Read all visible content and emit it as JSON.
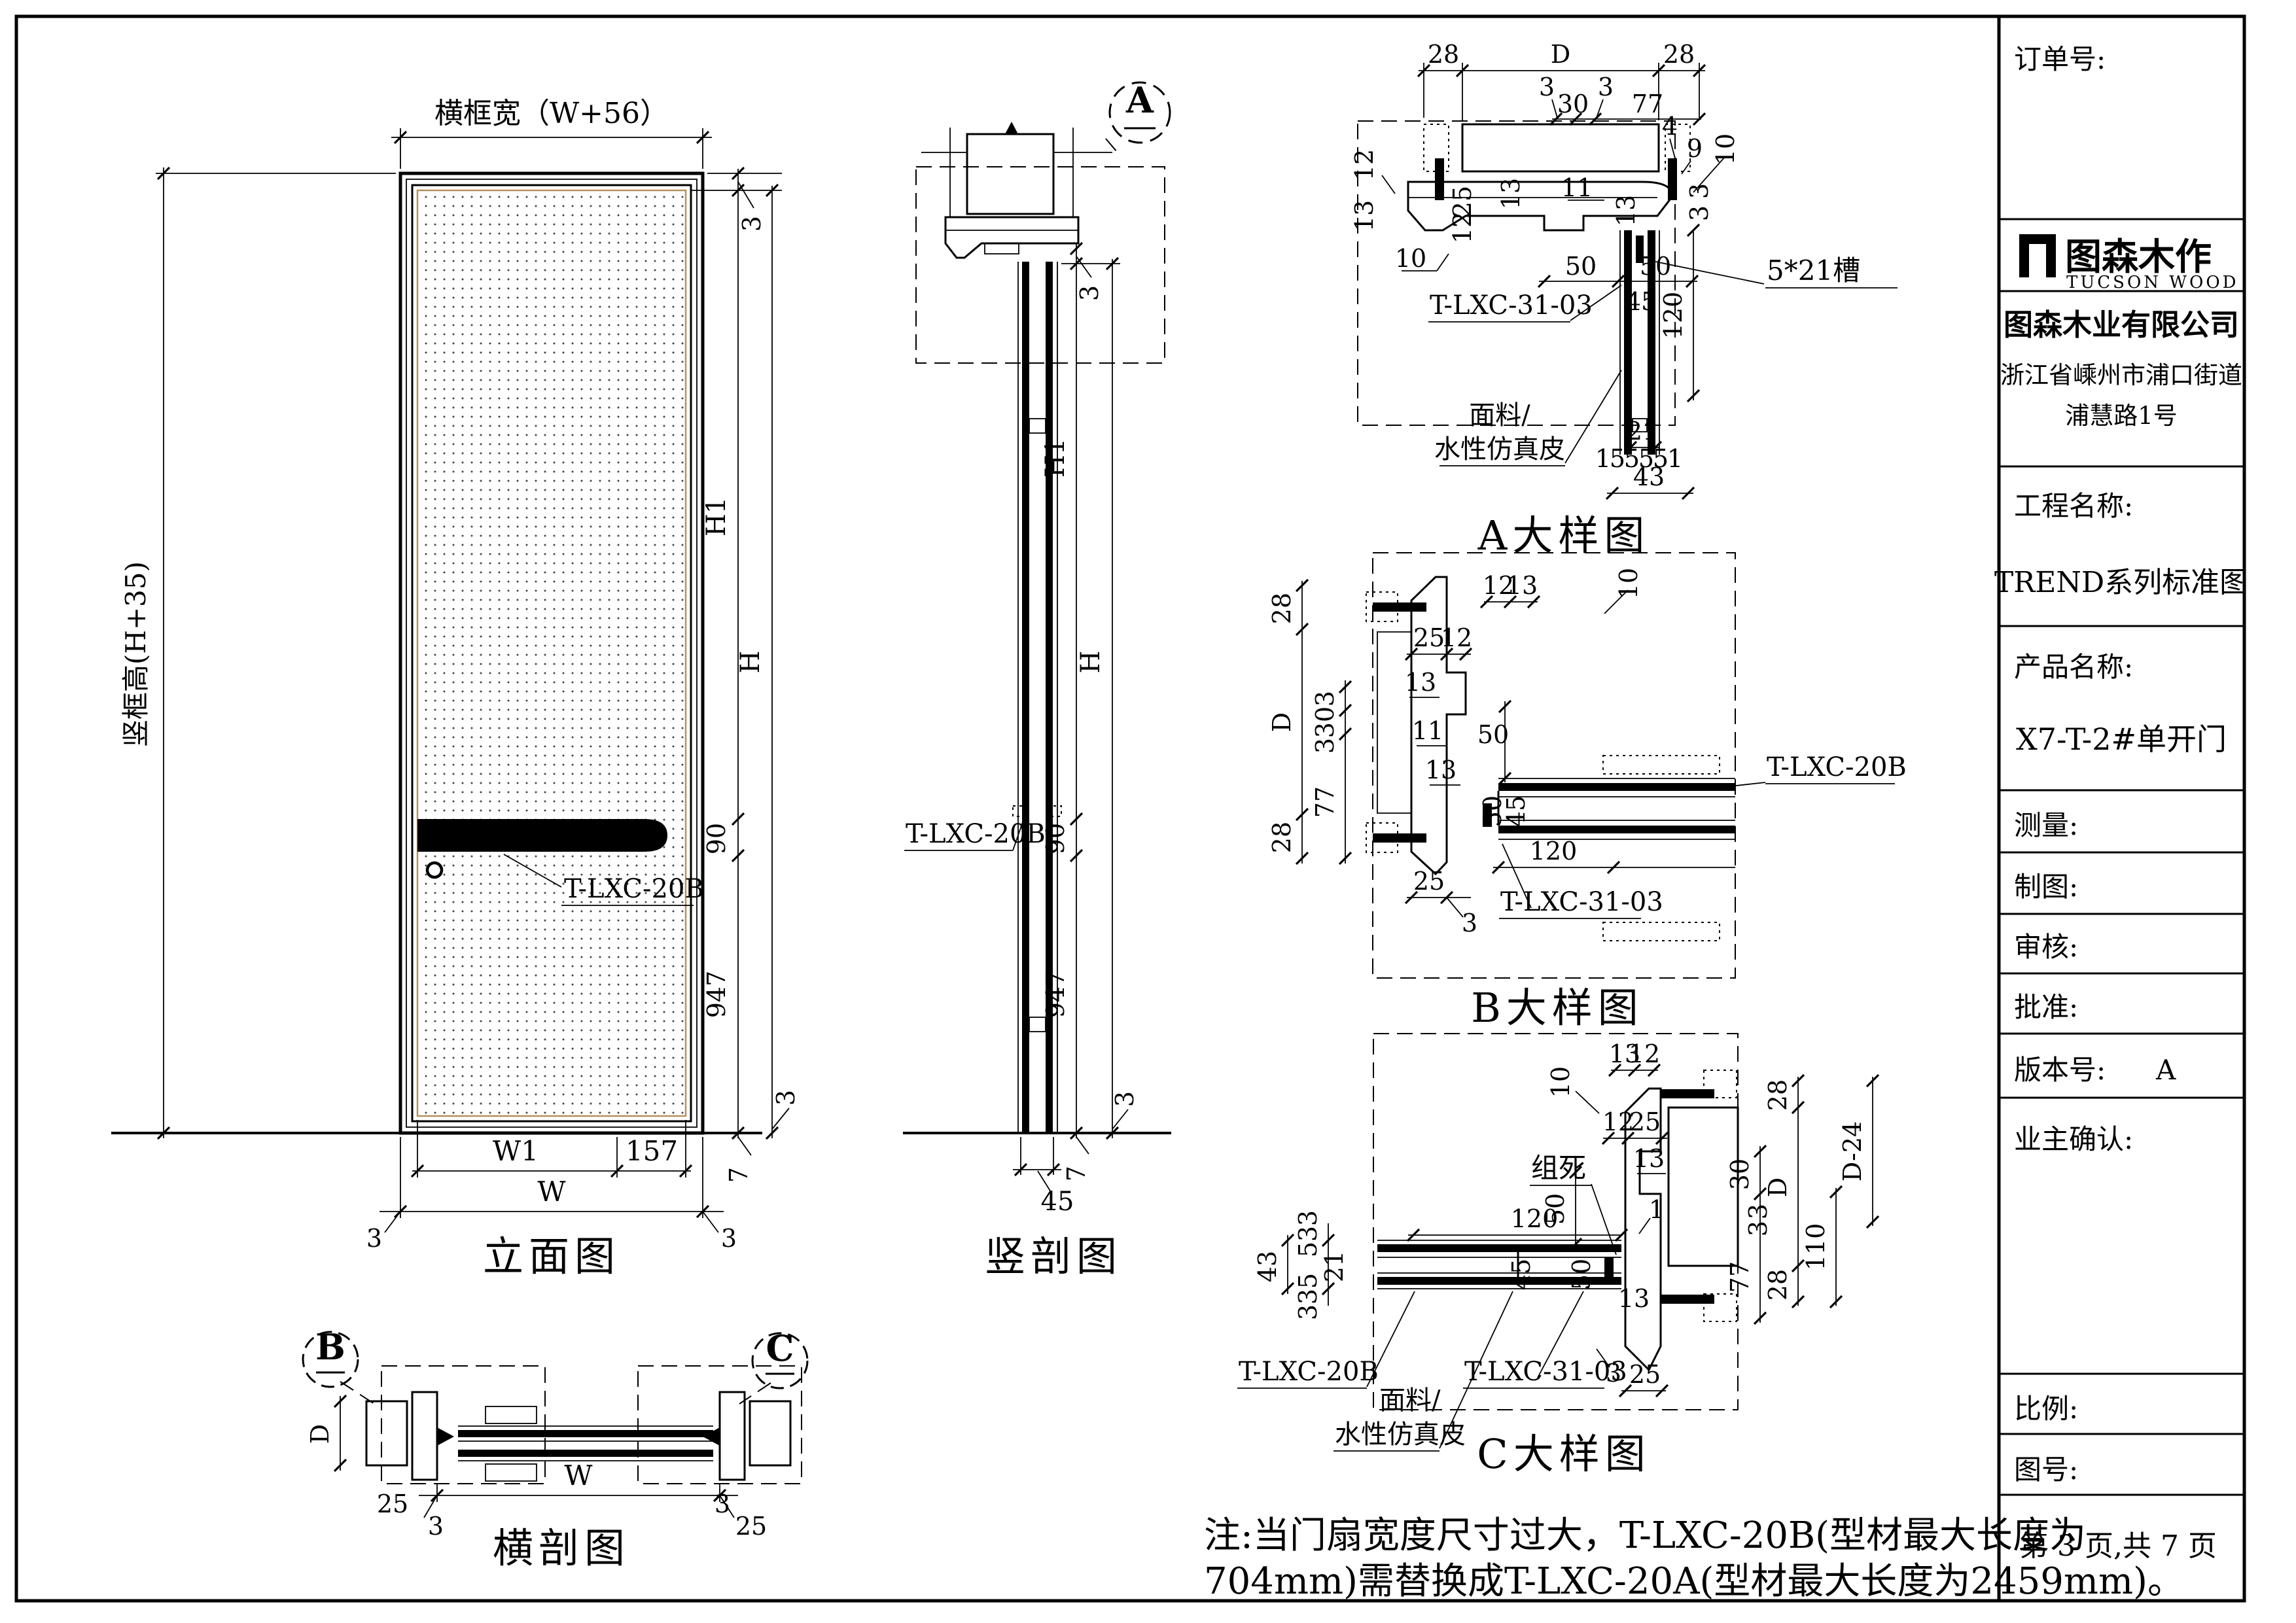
{
  "sheet": {
    "order_label": "订单号:",
    "logo_cn": "图森木作",
    "logo_en": "TUCSON WOOD",
    "company": "图森木业有限公司",
    "address1": "浙江省嵊州市浦口街道",
    "address2": "浦慧路1号",
    "project_label": "工程名称:",
    "project_value": "TREND系列标准图",
    "product_label": "产品名称:",
    "product_value": "X7-T-2#单开门",
    "measure_label": "测量:",
    "draft_label": "制图:",
    "review_label": "审核:",
    "approve_label": "批准:",
    "version_label": "版本号:",
    "version_value": "A",
    "owner_label": "业主确认:",
    "scale_label": "比例:",
    "drawing_no_label": "图号:",
    "page_info": "第 3 页,共 7 页"
  },
  "cap": {
    "elevation": "立面图",
    "section_v": "竖剖图",
    "section_h": "横剖图",
    "detail_a": "A大样图",
    "detail_b": "B大样图",
    "detail_c": "C大样图"
  },
  "lbl": {
    "t20b": "T-LXC-20B",
    "t3103": "T-LXC-31-03",
    "slot": "5*21槽",
    "fabric1": "面料/",
    "fabric2": "水性仿真皮",
    "screw": "组死",
    "mA": "A",
    "mB": "B",
    "mC": "C"
  },
  "dim": {
    "frame_w": "横框宽（W+56）",
    "frame_h": "竖框高(H+35)"
  },
  "n": {
    "n1": "1",
    "n3": "3",
    "n4": "4",
    "n5": "5",
    "n7": "7",
    "n9": "9",
    "n10": "10",
    "n11": "11",
    "n12": "12",
    "n13": "13",
    "n21": "21",
    "n25": "25",
    "n28": "28",
    "n30": "30",
    "n43": "43",
    "n45": "45",
    "n50": "50",
    "n77": "77",
    "n90": "90",
    "n110": "110",
    "n120": "120",
    "n157": "157",
    "n947": "947",
    "D": "D",
    "D24": "D-24",
    "H": "H",
    "H1": "H1",
    "W": "W",
    "W1": "W1"
  },
  "note": {
    "line1": "注:当门扇宽度尺寸过大，T-LXC-20B(型材最大长度为",
    "line2": "704mm)需替换成T-LXC-20A(型材最大长度为2459mm)。"
  },
  "colors": {
    "ink": "#000000",
    "leaf_edge": "#b5915f"
  }
}
